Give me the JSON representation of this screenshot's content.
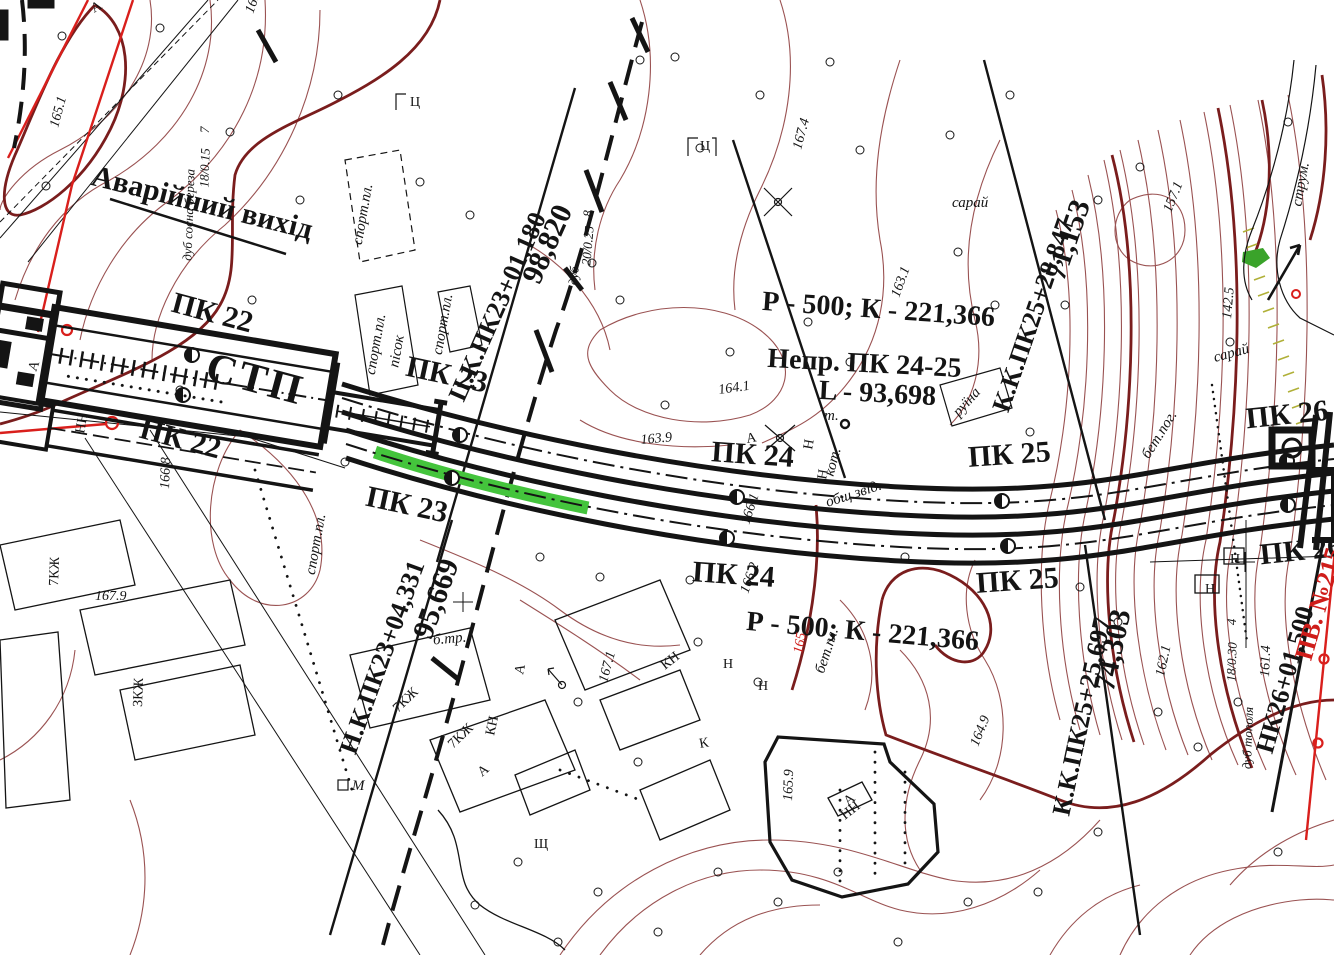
{
  "colors": {
    "contour_thin": "#9a5252",
    "contour_bold": "#7a1d1d",
    "highlight_green": "#44c43c",
    "accent_red": "#d91f1c",
    "slope_hatch_olive": "#b0b038",
    "line_black": "#141414"
  },
  "alignment": {
    "station_label": "СТП",
    "emergency_exit": "Аварійний вихід",
    "pickets": {
      "pk22": "ПК 22",
      "pk23": "ПК 23",
      "pk24": "ПК 24",
      "pk25": "ПК 25",
      "pk26": "ПК 26"
    },
    "curve_note": "Р - 500; К - 221,366",
    "transition_note_line1": "Непр. ПК 24-25",
    "transition_note_line2": "L - 93,698",
    "chainage_marks": {
      "ck": {
        "station": "Ц.К.ПК23+01,180",
        "distance": "98,820"
      },
      "nk": {
        "station": "Н.К.ПК23+04,331",
        "distance": "95,669"
      },
      "kk_upper": {
        "station": "К.К.ПК25+28,847",
        "distance": "71,153"
      },
      "kk_lower": {
        "station": "К.К.ПК25+25,697",
        "distance": "74,303"
      },
      "nk26": {
        "station": "НК26+01,500"
      },
      "pv": {
        "station": "ПВ. №215"
      }
    }
  },
  "topo_labels": {
    "sport_ground": "спорт.пл.",
    "sand": "пісок",
    "stream": "струм.",
    "ruin": "руїна",
    "boiler": "кот.",
    "shed": "сарай",
    "concrete": "бет.пог.",
    "revetment": "общ.звід.",
    "concrete_pl": "бет.пл.",
    "b_tr": "б.тр.",
    "point": "т.",
    "m": "М",
    "sheet": "Ц"
  },
  "trees": [
    {
      "species": "дуб сосна береза",
      "size": "18/0.15",
      "count": "7"
    },
    {
      "species": "дуб",
      "size": "20/0.25",
      "count": "8"
    },
    {
      "species": "дуб тополя",
      "size": "18/0.30",
      "count": "4"
    }
  ],
  "elevations": [
    "165.1",
    "161.9",
    "167.4",
    "163.1",
    "157.1",
    "142.5",
    "164.1",
    "163.9",
    "166.8",
    "167.9",
    "166.2",
    "166.1",
    "167.1",
    "165.9",
    "164.9",
    "162.1",
    "161.4",
    "165"
  ],
  "building_letters": [
    "КН",
    "Н",
    "К",
    "Н",
    "НН",
    "7КЖ",
    "КН",
    "7КЖ",
    "ЗКЖ",
    "7КЖ",
    "НН",
    "Н",
    "Н",
    "Щ",
    "Н",
    "Н"
  ],
  "parcel_letter": "А"
}
